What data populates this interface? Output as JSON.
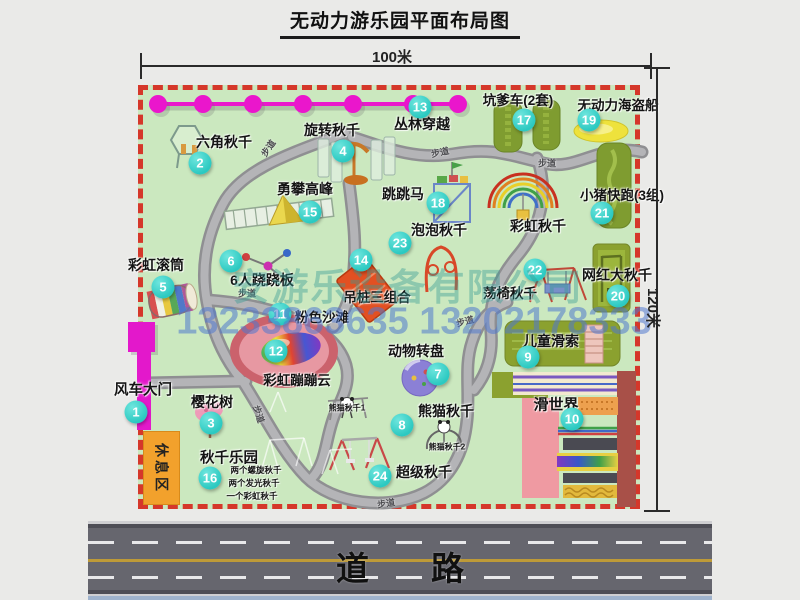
{
  "title": "无动力游乐园平面布局图",
  "dimensions": {
    "horizontal": "100米",
    "vertical": "120米"
  },
  "watermark": {
    "company": "安游乐设备有限公司",
    "phones": "13233863635 13202178333"
  },
  "road_label": "道路",
  "rest_area_label": "休息区",
  "walkway_label": "步道",
  "colors": {
    "marker": "#2cc9c1",
    "map_border": "#d5372a",
    "map_bg": "#cbe8bf",
    "zipline": "#ea16cc",
    "gate": "#e318cb",
    "rest_area": "#f2a12c"
  },
  "attractions": [
    {
      "id": 1,
      "name": "风车大门",
      "marker": {
        "x": 136,
        "y": 412
      },
      "label": {
        "x": 143,
        "y": 389,
        "s": 14.5
      }
    },
    {
      "id": 2,
      "name": "六角秋千",
      "marker": {
        "x": 200,
        "y": 163
      },
      "label": {
        "x": 224,
        "y": 142,
        "s": 14
      }
    },
    {
      "id": 3,
      "name": "樱花树",
      "marker": {
        "x": 211,
        "y": 423
      },
      "label": {
        "x": 212,
        "y": 402,
        "s": 14
      }
    },
    {
      "id": 4,
      "name": "旋转秋千",
      "marker": {
        "x": 343,
        "y": 151
      },
      "label": {
        "x": 332,
        "y": 130,
        "s": 14
      }
    },
    {
      "id": 5,
      "name": "彩虹滚筒",
      "marker": {
        "x": 163,
        "y": 287
      },
      "label": {
        "x": 156,
        "y": 265,
        "s": 14
      }
    },
    {
      "id": 6,
      "name": "6人跷跷板",
      "marker": {
        "x": 231,
        "y": 261
      },
      "label": {
        "x": 262,
        "y": 280,
        "s": 14
      }
    },
    {
      "id": 7,
      "name": "动物转盘",
      "marker": {
        "x": 438,
        "y": 374
      },
      "label": {
        "x": 416,
        "y": 351,
        "s": 14
      }
    },
    {
      "id": 8,
      "name": "熊猫秋千",
      "marker": {
        "x": 402,
        "y": 425
      },
      "label": {
        "x": 446,
        "y": 411,
        "s": 14
      }
    },
    {
      "id": 9,
      "name": "儿童滑索",
      "marker": {
        "x": 528,
        "y": 357
      },
      "label": {
        "x": 551,
        "y": 341,
        "s": 14
      }
    },
    {
      "id": 10,
      "name": "滑世界",
      "marker": {
        "x": 572,
        "y": 419
      },
      "label": {
        "x": 556,
        "y": 404,
        "s": 15
      }
    },
    {
      "id": 11,
      "name": "粉色沙滩",
      "marker": {
        "x": 280,
        "y": 314
      },
      "label": {
        "x": 322,
        "y": 316,
        "s": 13.5
      }
    },
    {
      "id": 12,
      "name": "彩虹蹦蹦云",
      "marker": {
        "x": 276,
        "y": 351
      },
      "label": {
        "x": 297,
        "y": 379,
        "s": 13.5
      }
    },
    {
      "id": 13,
      "name": "丛林穿越",
      "marker": {
        "x": 420,
        "y": 107
      },
      "label": {
        "x": 422,
        "y": 124,
        "s": 14
      }
    },
    {
      "id": 14,
      "name": "吊桩三组合",
      "marker": {
        "x": 361,
        "y": 260
      },
      "label": {
        "x": 377,
        "y": 296,
        "s": 13.5
      }
    },
    {
      "id": 15,
      "name": "勇攀高峰",
      "marker": {
        "x": 310,
        "y": 212
      },
      "label": {
        "x": 305,
        "y": 189,
        "s": 14
      }
    },
    {
      "id": 16,
      "name": "秋千乐园",
      "marker": {
        "x": 210,
        "y": 478
      },
      "label": {
        "x": 229,
        "y": 457,
        "s": 14.5
      }
    },
    {
      "id": 17,
      "name": "坑爹车(2套)",
      "marker": {
        "x": 524,
        "y": 120
      },
      "label": {
        "x": 518,
        "y": 99,
        "s": 13.5
      }
    },
    {
      "id": 18,
      "name": "跳跳马",
      "marker": {
        "x": 438,
        "y": 203
      },
      "label": {
        "x": 403,
        "y": 194,
        "s": 14
      }
    },
    {
      "id": 19,
      "name": "无动力海盗船",
      "marker": {
        "x": 589,
        "y": 120
      },
      "label": {
        "x": 618,
        "y": 104,
        "s": 13.5
      }
    },
    {
      "id": 20,
      "name": "网红大秋千",
      "marker": {
        "x": 618,
        "y": 296
      },
      "label": {
        "x": 617,
        "y": 275,
        "s": 14
      }
    },
    {
      "id": 21,
      "name": "小猪快跑(3组)",
      "marker": {
        "x": 602,
        "y": 213
      },
      "label": {
        "x": 622,
        "y": 194,
        "s": 13.5
      }
    },
    {
      "id": 22,
      "name": "荡椅秋千",
      "marker": {
        "x": 535,
        "y": 270
      },
      "label": {
        "x": 510,
        "y": 292,
        "s": 13.5
      }
    },
    {
      "id": 23,
      "name": "泡泡秋千",
      "marker": {
        "x": 400,
        "y": 243
      },
      "label": {
        "x": 439,
        "y": 230,
        "s": 14
      }
    },
    {
      "id": 24,
      "name": "超级秋千",
      "marker": {
        "x": 380,
        "y": 476
      },
      "label": {
        "x": 424,
        "y": 472,
        "s": 14
      }
    }
  ],
  "annotations": [
    {
      "text": "彩虹秋千",
      "x": 538,
      "y": 226,
      "s": 14
    },
    {
      "text": "熊猫秋千1",
      "x": 347,
      "y": 408,
      "s": 8
    },
    {
      "text": "熊猫秋千2",
      "x": 447,
      "y": 447,
      "s": 8
    },
    {
      "text": "两个螺旋秋千",
      "x": 256,
      "y": 470,
      "s": 8.5
    },
    {
      "text": "两个发光秋千",
      "x": 254,
      "y": 483,
      "s": 8.5
    },
    {
      "text": "一个彩虹秋千",
      "x": 252,
      "y": 496,
      "s": 8.5
    }
  ],
  "walkway_positions": [
    {
      "x": 268,
      "y": 148,
      "r": -55
    },
    {
      "x": 440,
      "y": 152,
      "r": -12
    },
    {
      "x": 547,
      "y": 163,
      "r": 0
    },
    {
      "x": 247,
      "y": 293,
      "r": 0
    },
    {
      "x": 465,
      "y": 321,
      "r": -15
    },
    {
      "x": 259,
      "y": 414,
      "r": 72
    },
    {
      "x": 386,
      "y": 503,
      "r": -8
    }
  ]
}
